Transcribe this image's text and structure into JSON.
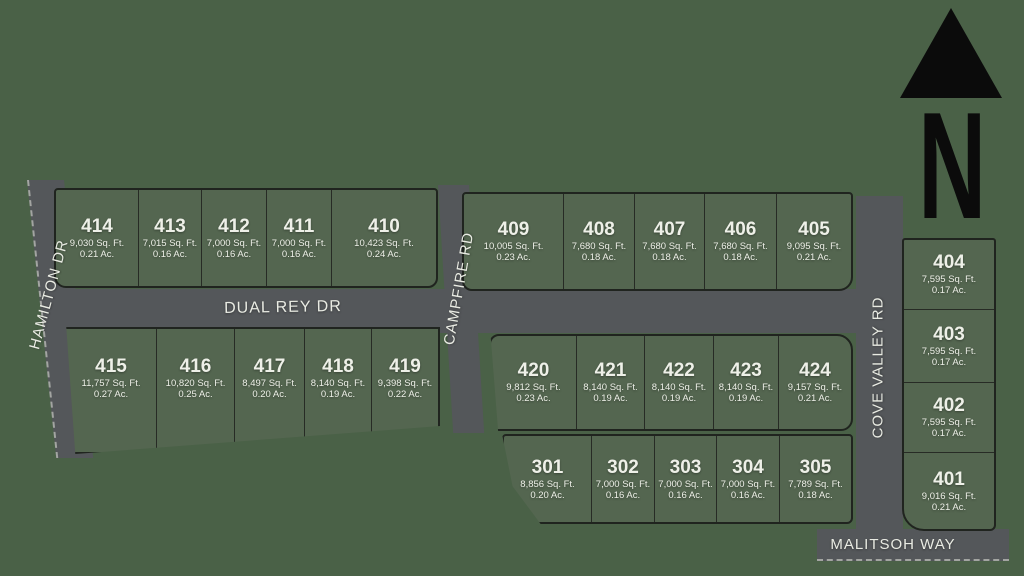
{
  "legend": {
    "north_label": "N"
  },
  "streets": {
    "hamilton": "HAMILTON DR",
    "dual_rey": "DUAL REY DR",
    "campfire": "CAMPFIRE RD",
    "cove_valley": "COVE VALLEY RD",
    "malitsoh": "MALITSOH WAY"
  },
  "lots": {
    "top_left": [
      {
        "num": "414",
        "sqft": "9,030 Sq. Ft.",
        "ac": "0.21 Ac."
      },
      {
        "num": "413",
        "sqft": "7,015 Sq. Ft.",
        "ac": "0.16 Ac."
      },
      {
        "num": "412",
        "sqft": "7,000 Sq. Ft.",
        "ac": "0.16 Ac."
      },
      {
        "num": "411",
        "sqft": "7,000 Sq. Ft.",
        "ac": "0.16 Ac."
      },
      {
        "num": "410",
        "sqft": "10,423 Sq. Ft.",
        "ac": "0.24 Ac."
      }
    ],
    "top_right": [
      {
        "num": "409",
        "sqft": "10,005 Sq. Ft.",
        "ac": "0.23 Ac."
      },
      {
        "num": "408",
        "sqft": "7,680 Sq. Ft.",
        "ac": "0.18 Ac."
      },
      {
        "num": "407",
        "sqft": "7,680 Sq. Ft.",
        "ac": "0.18 Ac."
      },
      {
        "num": "406",
        "sqft": "7,680 Sq. Ft.",
        "ac": "0.18 Ac."
      },
      {
        "num": "405",
        "sqft": "9,095 Sq. Ft.",
        "ac": "0.21 Ac."
      }
    ],
    "mid_left": [
      {
        "num": "415",
        "sqft": "11,757 Sq. Ft.",
        "ac": "0.27 Ac."
      },
      {
        "num": "416",
        "sqft": "10,820 Sq. Ft.",
        "ac": "0.25 Ac."
      },
      {
        "num": "417",
        "sqft": "8,497 Sq. Ft.",
        "ac": "0.20 Ac."
      },
      {
        "num": "418",
        "sqft": "8,140 Sq. Ft.",
        "ac": "0.19 Ac."
      },
      {
        "num": "419",
        "sqft": "9,398 Sq. Ft.",
        "ac": "0.22 Ac."
      }
    ],
    "mid_right": [
      {
        "num": "420",
        "sqft": "9,812 Sq. Ft.",
        "ac": "0.23 Ac."
      },
      {
        "num": "421",
        "sqft": "8,140 Sq. Ft.",
        "ac": "0.19 Ac."
      },
      {
        "num": "422",
        "sqft": "8,140 Sq. Ft.",
        "ac": "0.19 Ac."
      },
      {
        "num": "423",
        "sqft": "8,140 Sq. Ft.",
        "ac": "0.19 Ac."
      },
      {
        "num": "424",
        "sqft": "9,157 Sq. Ft.",
        "ac": "0.21 Ac."
      }
    ],
    "bottom": [
      {
        "num": "301",
        "sqft": "8,856 Sq. Ft.",
        "ac": "0.20 Ac."
      },
      {
        "num": "302",
        "sqft": "7,000 Sq. Ft.",
        "ac": "0.16 Ac."
      },
      {
        "num": "303",
        "sqft": "7,000 Sq. Ft.",
        "ac": "0.16 Ac."
      },
      {
        "num": "304",
        "sqft": "7,000 Sq. Ft.",
        "ac": "0.16 Ac."
      },
      {
        "num": "305",
        "sqft": "7,789 Sq. Ft.",
        "ac": "0.18 Ac."
      }
    ],
    "east": [
      {
        "num": "404",
        "sqft": "7,595 Sq. Ft.",
        "ac": "0.17 Ac."
      },
      {
        "num": "403",
        "sqft": "7,595 Sq. Ft.",
        "ac": "0.17 Ac."
      },
      {
        "num": "402",
        "sqft": "7,595 Sq. Ft.",
        "ac": "0.17 Ac."
      },
      {
        "num": "401",
        "sqft": "9,016 Sq. Ft.",
        "ac": "0.21 Ac."
      }
    ]
  },
  "colors": {
    "background": "#4a6147",
    "lot_fill": "#546650",
    "road_fill": "#54575a",
    "outline": "#20241f",
    "label_text": "#eef0e8",
    "north_arrow": "#0b0b0b"
  }
}
